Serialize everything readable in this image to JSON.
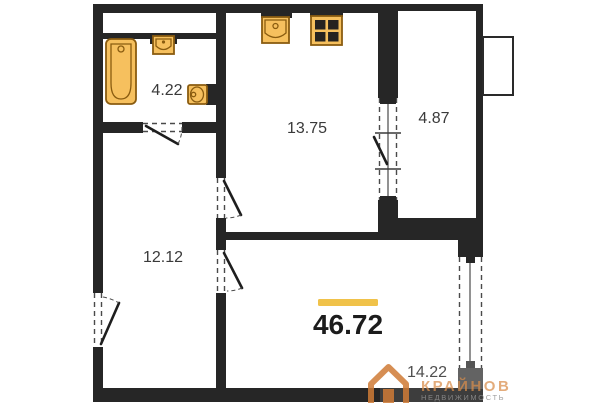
{
  "colors": {
    "wall": "#262626",
    "fixture_fill": "#f6c05e",
    "fixture_stroke": "#8a5c10",
    "accent": "#f0c24a",
    "label_text": "#3a3a3a",
    "muted_label_text": "#4f4f4f",
    "watermark_orange": "#cf7b36",
    "watermark_gray": "#909090"
  },
  "floorplan": {
    "rooms": [
      {
        "name": "bathroom",
        "area": "4.22"
      },
      {
        "name": "kitchen",
        "area": "13.75"
      },
      {
        "name": "balcony",
        "area": "4.87"
      },
      {
        "name": "hallway",
        "area": "12.12"
      },
      {
        "name": "living-room",
        "area": "14.22"
      }
    ],
    "total_area": {
      "value": "46.72"
    },
    "fixtures": [
      "bathtub-icon",
      "bathroom-sink-icon",
      "toilet-icon",
      "kitchen-sink-icon",
      "stove-icon"
    ],
    "openings": [
      "entrance-door",
      "bathroom-door",
      "kitchen-door",
      "room-door",
      "balcony-door-window",
      "room-window"
    ]
  },
  "watermark": {
    "brand": "КРАЙНОВ",
    "subtitle": "НЕДВИЖИМОСТЬ",
    "logo": "house-logo-icon"
  }
}
